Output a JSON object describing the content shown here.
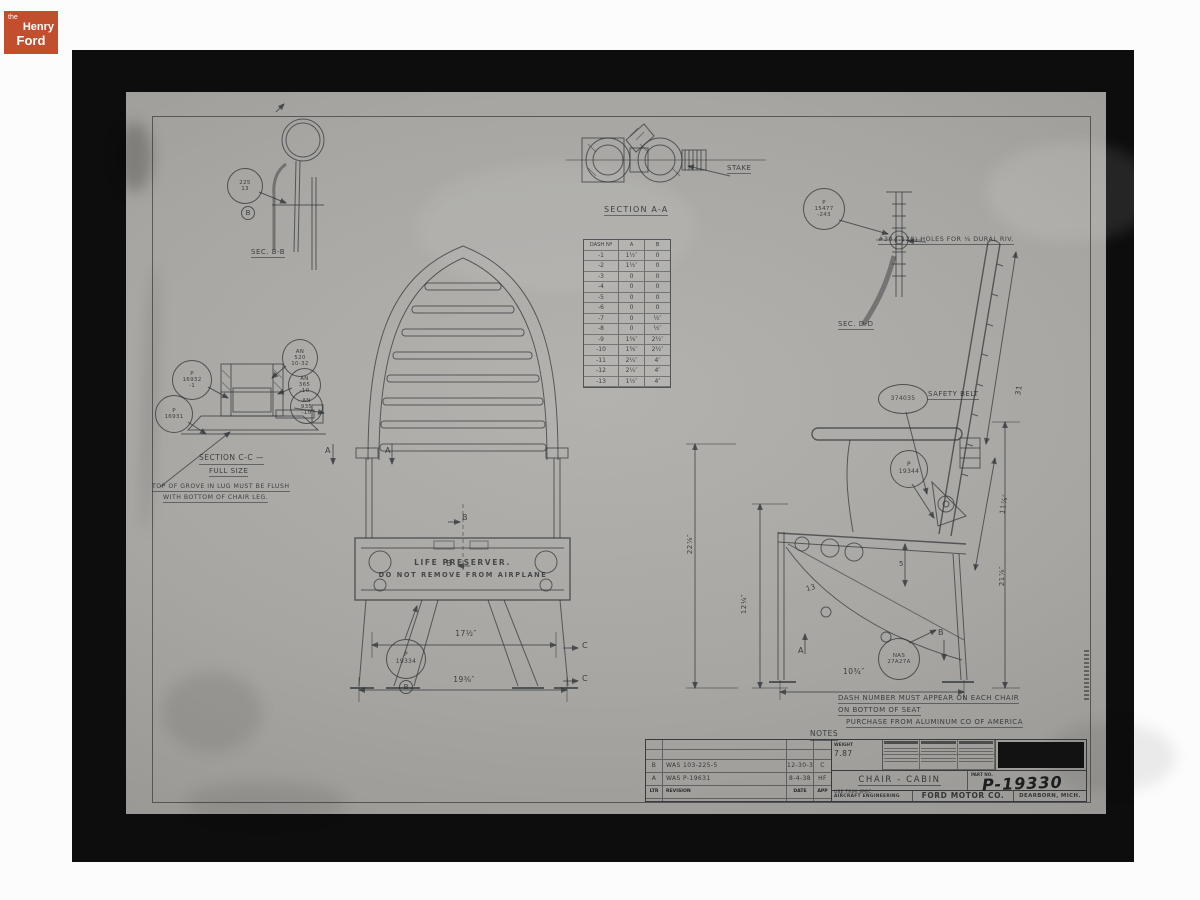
{
  "logo": {
    "the": "the",
    "henry": "Henry",
    "ford": "Ford"
  },
  "colors": {
    "logo_red": "#c14e2c",
    "paper_grey": "#a7a5a2",
    "ink": "#2e3236",
    "frame_black": "#0d0d0d"
  },
  "sec_bb": {
    "balloon": [
      "225",
      "13"
    ],
    "marker": "B",
    "caption": "SEC. B-B"
  },
  "section_aa": {
    "caption": "SECTION A-A",
    "stake": "STAKE"
  },
  "sec_dd": {
    "balloon": [
      "P",
      "15477",
      "-243"
    ],
    "note": "#30 (.128) HOLES FOR ⅛ DURAL RIV.",
    "caption": "SEC. D-D"
  },
  "section_cc": {
    "b_p16932": [
      "P",
      "16932",
      "-1"
    ],
    "b_p16931": [
      "P",
      "16931"
    ],
    "b_an520": [
      "AN",
      "520",
      "10-32"
    ],
    "b_an365": [
      "AN",
      "365",
      "-10"
    ],
    "b_an935": [
      "AN",
      "935",
      "-10"
    ],
    "caption": "SECTION C-C —",
    "subcaption": "FULL SIZE",
    "note1": "TOP OF GROVE IN LUG MUST BE FLUSH",
    "note2": "WITH BOTTOM OF CHAIR LEG."
  },
  "dash_table": {
    "headers": [
      "DASH Nº",
      "A",
      "B"
    ],
    "rows": [
      [
        "-1",
        "1½″",
        "0"
      ],
      [
        "-2",
        "1½″",
        "0"
      ],
      [
        "-3",
        "0",
        "0"
      ],
      [
        "-4",
        "0",
        "0"
      ],
      [
        "-5",
        "0",
        "0"
      ],
      [
        "-6",
        "0",
        "0"
      ],
      [
        "-7",
        "0",
        "½″"
      ],
      [
        "-8",
        "0",
        "½″"
      ],
      [
        "-9",
        "1⅜″",
        "2½″"
      ],
      [
        "-10",
        "1⅜″",
        "2½″"
      ],
      [
        "-11",
        "2¼″",
        "4″"
      ],
      [
        "-12",
        "2¼″",
        "4″"
      ],
      [
        "-13",
        "1½″",
        "4″"
      ]
    ]
  },
  "front_view": {
    "stencil1": "LIFE PRESERVER.",
    "stencil2": "DO NOT REMOVE FROM AIRPLANE",
    "dim_width": "17½″",
    "dim_base": "19⅜″",
    "balloon": [
      "P",
      "19334"
    ],
    "balloon_marker": "B",
    "marker_a": "A",
    "marker_b": "B",
    "marker_c": "C"
  },
  "side_view": {
    "balloon_belt": "374035",
    "belt_label": "SAFETY BELT",
    "balloon_p19344": [
      "P",
      "19344"
    ],
    "balloon_nas": [
      "NAS",
      "27A27A"
    ],
    "dim_31": "31",
    "dim_11": "11⅞″",
    "dim_21": "21⅞″",
    "dim_22": "22⅞″",
    "dim_12": "12¼″",
    "dim_13": "13",
    "dim_5": "5",
    "dim_10": "10¾″",
    "marker_a": "A",
    "marker_b": "B"
  },
  "notes": {
    "line1": "DASH NUMBER MUST APPEAR ON EACH CHAIR",
    "line2": "ON BOTTOM OF SEAT",
    "line3": "PURCHASE FROM ALUMINUM CO OF AMERICA",
    "heading": "NOTES"
  },
  "title_block": {
    "revisions": [
      {
        "ltr": "B",
        "desc": "WAS 103-225-5",
        "date": "12-30-38",
        "app": "C"
      },
      {
        "ltr": "A",
        "desc": "WAS P-19631",
        "date": "8-4-38",
        "app": "HF"
      }
    ],
    "rev_headers": [
      "LTR",
      "REVISION",
      "DATE",
      "APP"
    ],
    "weight_label": "WEIGHT",
    "weight_value": "7.87",
    "title": "CHAIR - CABIN",
    "part_label": "PART NO.",
    "part_no": "P-19330",
    "trim": "USE TRIM SPEC",
    "dept": "AIRCRAFT ENGINEERING",
    "company": "FORD MOTOR CO.",
    "location": "DEARBORN, MICH."
  }
}
